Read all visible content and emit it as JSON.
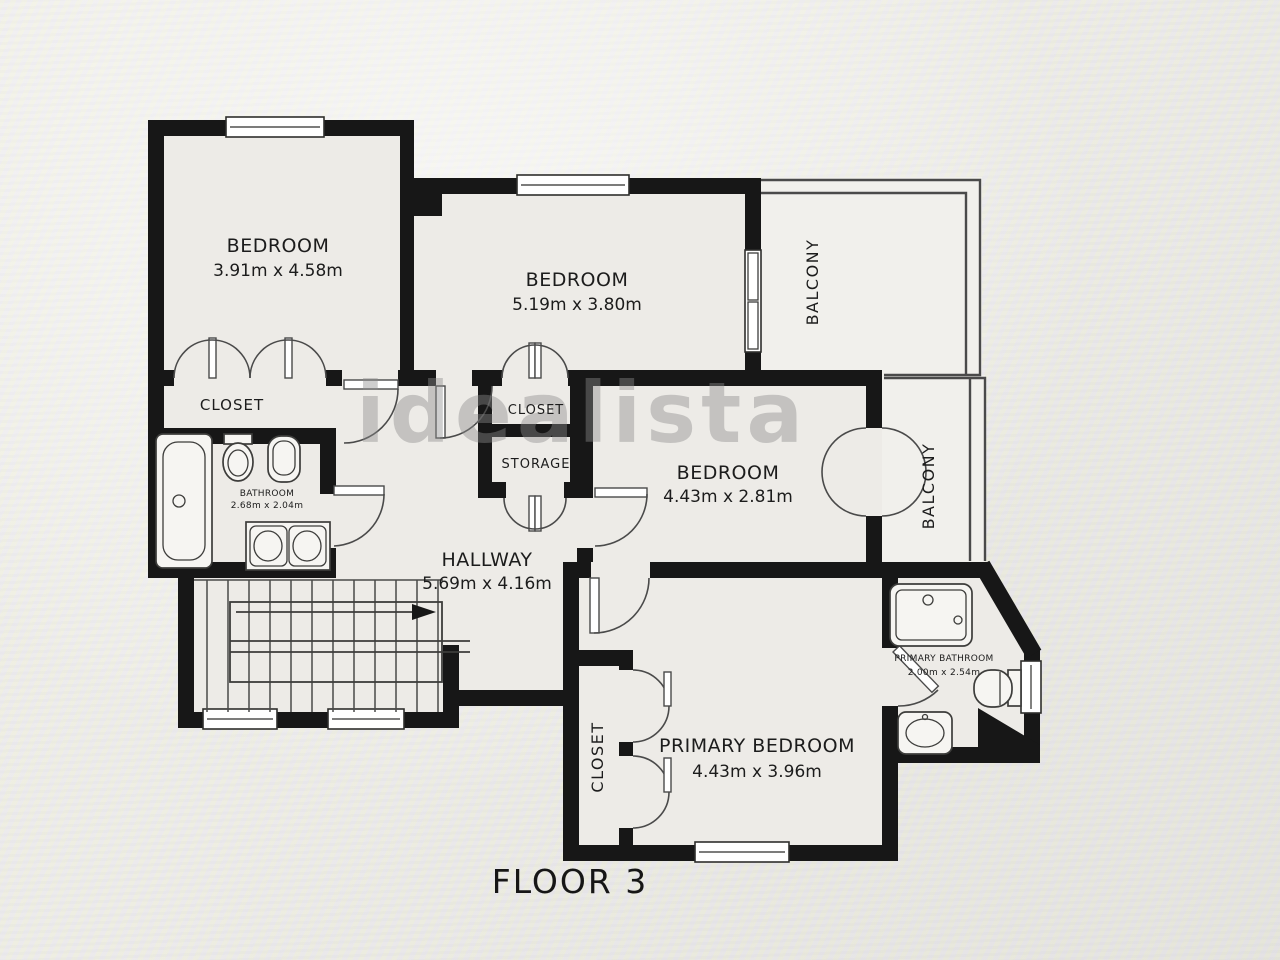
{
  "caption": "FLOOR 3",
  "watermark": "idealista",
  "rooms": {
    "bedroom1": {
      "name": "BEDROOM",
      "dims": "3.91m x 4.58m"
    },
    "bedroom2": {
      "name": "BEDROOM",
      "dims": "5.19m x 3.80m"
    },
    "bedroom3": {
      "name": "BEDROOM",
      "dims": "4.43m x 2.81m"
    },
    "primary_bedroom": {
      "name": "PRIMARY BEDROOM",
      "dims": "4.43m x 3.96m"
    },
    "hallway": {
      "name": "HALLWAY",
      "dims": "5.69m x 4.16m"
    },
    "bathroom": {
      "name": "BATHROOM",
      "dims": "2.68m x 2.04m"
    },
    "primary_bathroom": {
      "name": "PRIMARY BATHROOM",
      "dims": "2.00m x 2.54m"
    },
    "closet_bedroom1": {
      "name": "CLOSET"
    },
    "closet_middle": {
      "name": "CLOSET"
    },
    "storage": {
      "name": "STORAGE"
    },
    "closet_primary": {
      "name": "CLOSET"
    },
    "balcony_top": {
      "name": "BALCONY"
    },
    "balcony_right": {
      "name": "BALCONY"
    }
  },
  "colors": {
    "wall": "#171717",
    "line": "#4a4a4a",
    "text": "#1c1c1c",
    "watermark": "#8c8c8c",
    "floor": "#edebe7"
  }
}
